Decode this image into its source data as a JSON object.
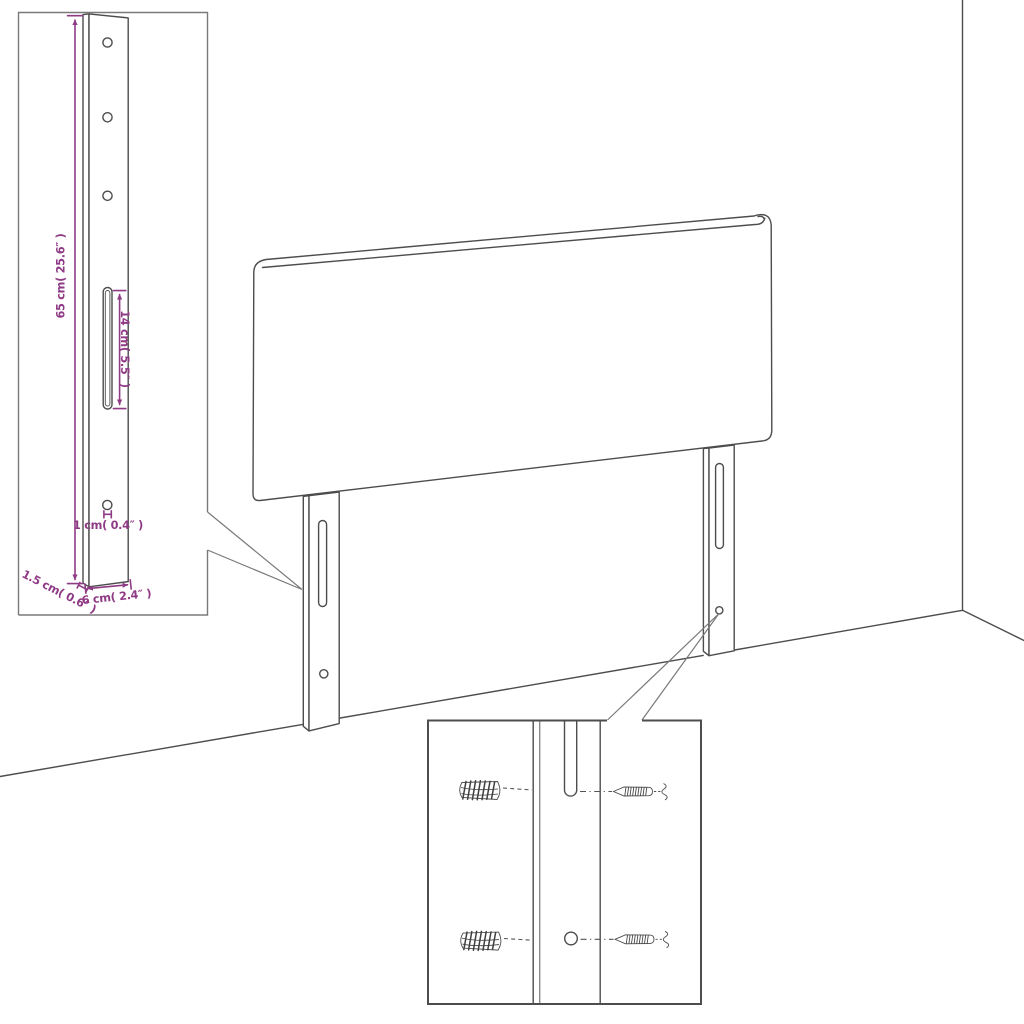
{
  "title": "Headboard wall-mounting dimension diagram",
  "colors": {
    "background": "#ffffff",
    "drawing_line": "#4d4d4d",
    "dimension_accent": "#8f3a85"
  },
  "main_drawing": {
    "name": "upholstered headboard with two wall-mount legs in room corner",
    "legs": 2,
    "slots_per_leg": 1,
    "holes_per_leg": 1
  },
  "insets": {
    "leg_detail": {
      "name": "mounting leg front view with dimensions",
      "holes": 4,
      "slots": 1,
      "dimensions": {
        "height": "65 cm( 25.6″ )",
        "slot_length": "14 cm( 5.5″ )",
        "hole_diameter": "1 cm( 0.4″ )",
        "thickness": "1.5 cm( 0.6″ )",
        "width": "6 cm( 2.4″ )"
      }
    },
    "mounting_detail": {
      "name": "wall plug and screw alignment close-up",
      "parts": [
        "wall plug",
        "screw",
        "keyhole slot",
        "screw hole"
      ]
    }
  }
}
